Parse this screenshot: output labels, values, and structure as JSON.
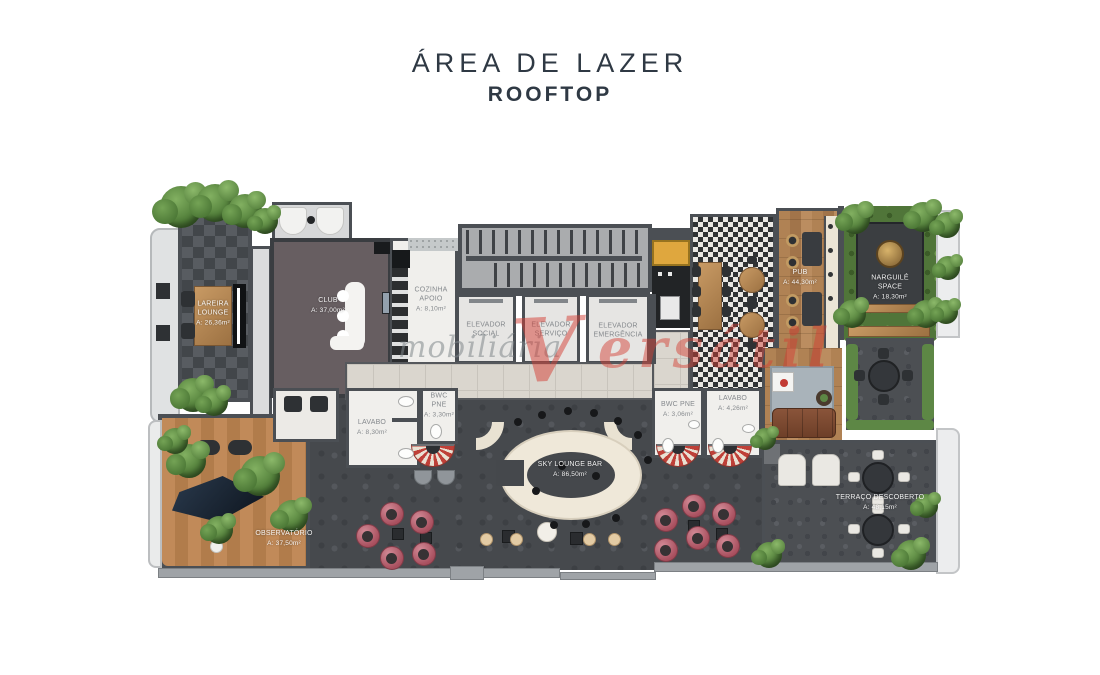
{
  "title": {
    "line1": "ÁREA DE LAZER",
    "line2": "ROOFTOP"
  },
  "watermark": {
    "left": "mobiliária",
    "logo": "V",
    "right": "ersátil"
  },
  "colors": {
    "wall": "#4b4f54",
    "stone_floor": "#46494d",
    "wood": "#b08254",
    "cream_bar": "#efe8d9",
    "pink_chair": "#b85f6e",
    "plant_green": "#5d8745",
    "yellow_cabinet": "#dfa73e",
    "watermark_red": "#d6423a",
    "title_text": "#2f3944"
  },
  "rooms": {
    "lareira_lounge": {
      "name": "LAREIRA LOUNGE",
      "area": "A: 26,36m²"
    },
    "club": {
      "name": "CLUB",
      "area": "A: 37,00m²"
    },
    "cozinha_apoio": {
      "name": "COZINHA APOIO",
      "area": "A: 8,10m²"
    },
    "elevador_social": {
      "name": "ELEVADOR SOCIAL"
    },
    "elevador_servico": {
      "name": "ELEVADOR SERVIÇO"
    },
    "elevador_emergencia": {
      "name": "ELEVADOR EMERGÊNCIA"
    },
    "pub": {
      "name": "PUB",
      "area": "A: 44,30m²"
    },
    "narguile_space": {
      "name": "NARGUILÉ SPACE",
      "area": "A: 18,30m²"
    },
    "lavabo_social": {
      "name": "LAVABO",
      "area": "A: 8,30m²"
    },
    "bwc_pne_1": {
      "name": "BWC PNE",
      "area": "A: 3,30m²"
    },
    "bwc_pne_2": {
      "name": "BWC PNE",
      "area": "A: 3,06m²"
    },
    "lavabo_2": {
      "name": "LAVABO",
      "area": "A: 4,26m²"
    },
    "sky_lounge_bar": {
      "name": "SKY LOUNGE BAR",
      "area": "A: 86,50m²"
    },
    "observatorio": {
      "name": "OBSERVATÓRIO",
      "area": "A: 37,50m²"
    },
    "terraco_descoberto": {
      "name": "TERRAÇO DESCOBERTO",
      "area": "A: 48,15m²"
    }
  }
}
